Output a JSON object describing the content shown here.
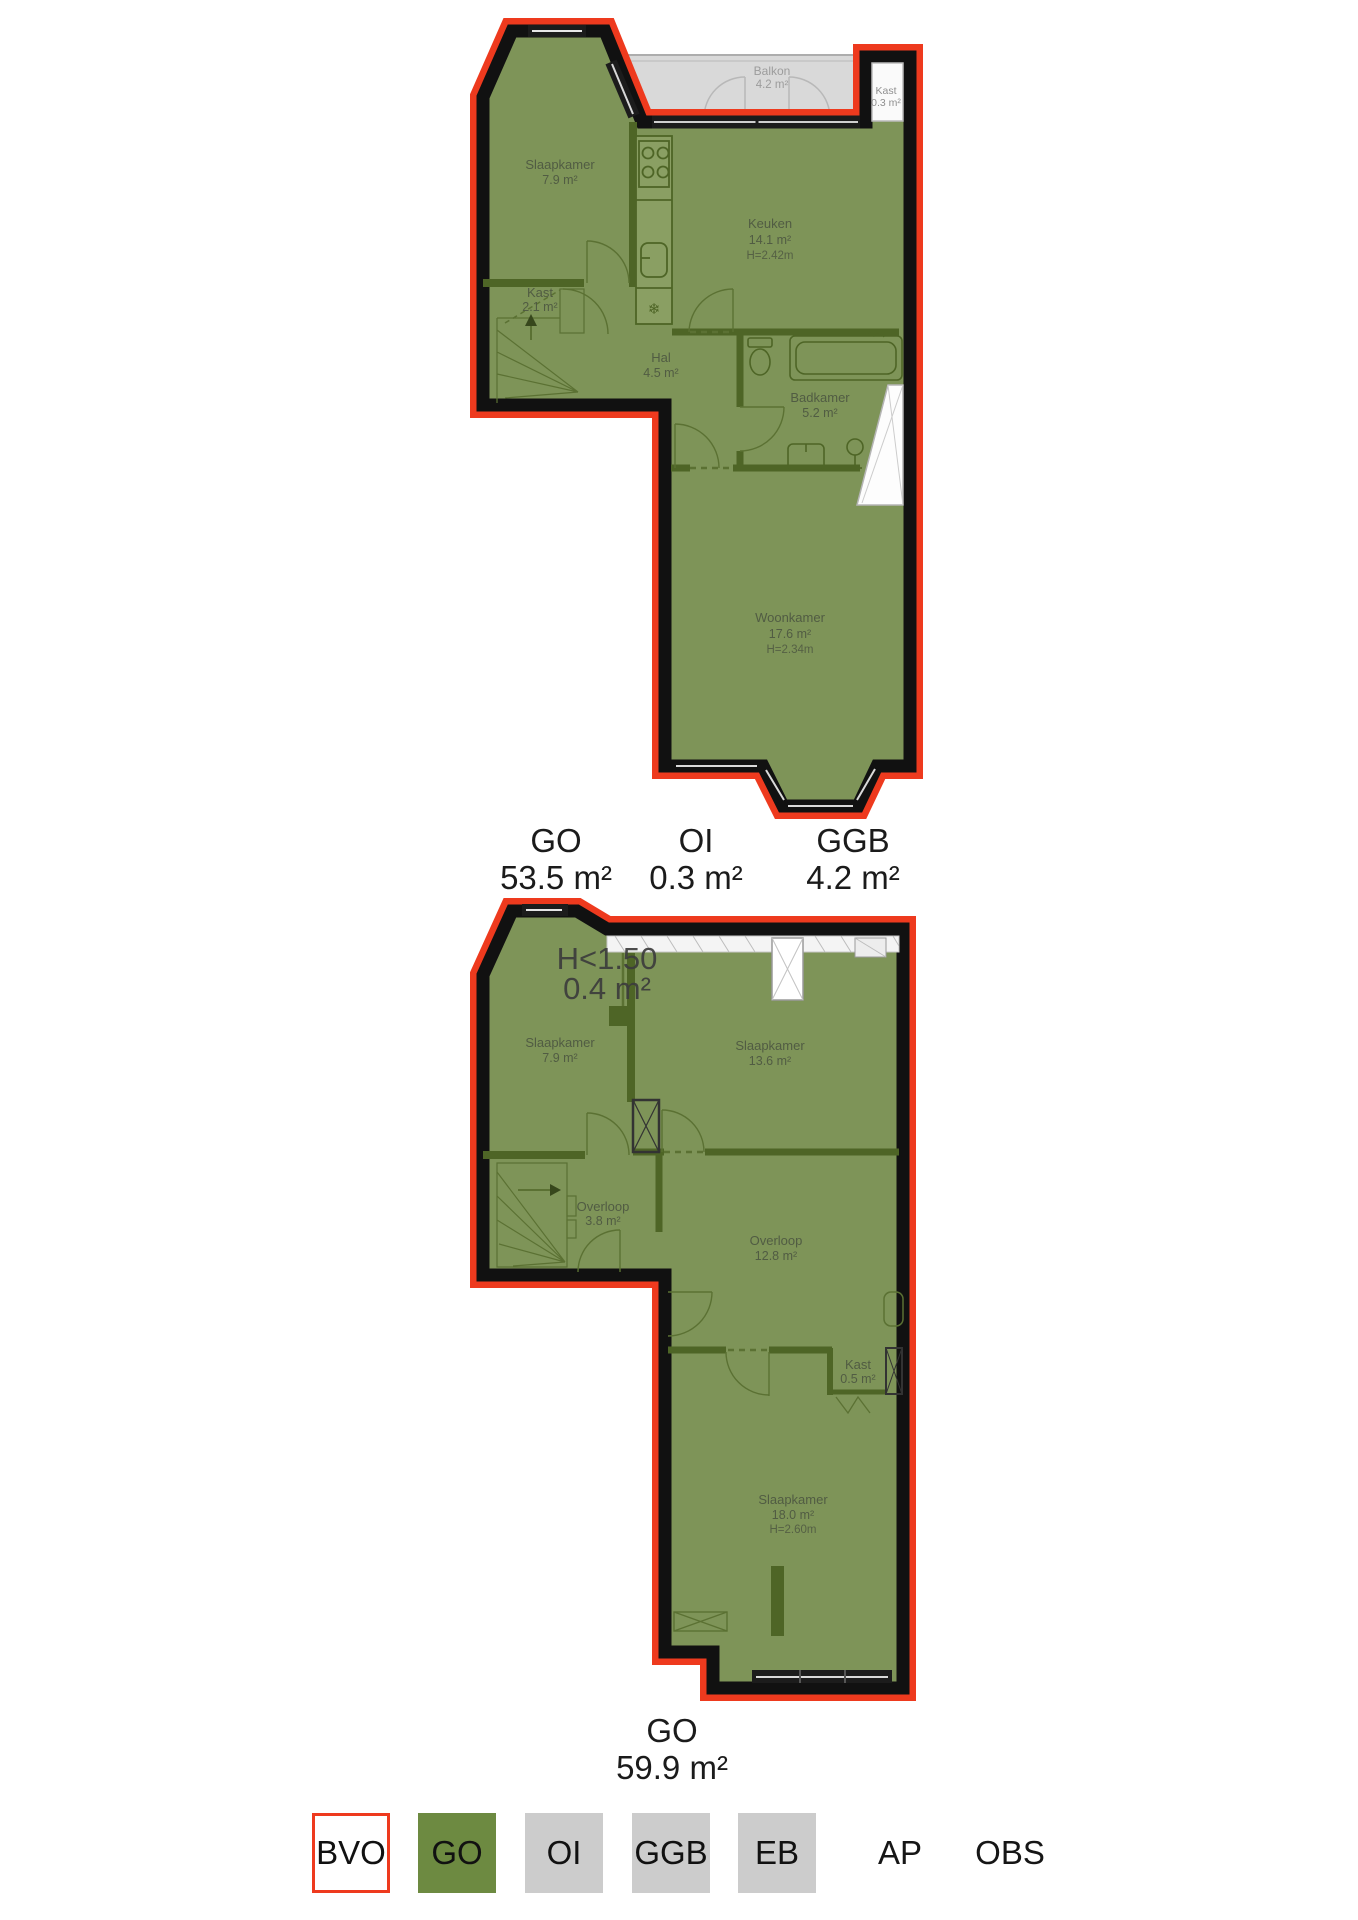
{
  "floor1": {
    "rooms": {
      "slaapkamer": {
        "name": "Slaapkamer",
        "area": "7.9 m²"
      },
      "keuken": {
        "name": "Keuken",
        "area": "14.1 m²",
        "height": "H=2.42m"
      },
      "kast": {
        "name": "Kast",
        "area": "2.1 m²"
      },
      "hal": {
        "name": "Hal",
        "area": "4.5 m²"
      },
      "badkamer": {
        "name": "Badkamer",
        "area": "5.2 m²"
      },
      "woonkamer": {
        "name": "Woonkamer",
        "area": "17.6 m²",
        "height": "H=2.34m"
      },
      "balkon": {
        "name": "Balkon",
        "area": "4.2 m²"
      },
      "kast_oi": {
        "name": "Kast",
        "area": "0.3 m²"
      }
    },
    "totals": {
      "go": {
        "label": "GO",
        "value": "53.5 m²"
      },
      "oi": {
        "label": "OI",
        "value": "0.3 m²"
      },
      "ggb": {
        "label": "GGB",
        "value": "4.2 m²"
      }
    }
  },
  "floor2": {
    "low_height_zone": {
      "label": "H<1.50",
      "value": "0.4 m²"
    },
    "rooms": {
      "slaapkamer_1": {
        "name": "Slaapkamer",
        "area": "7.9 m²"
      },
      "slaapkamer_2": {
        "name": "Slaapkamer",
        "area": "13.6 m²"
      },
      "overloop_klein": {
        "name": "Overloop",
        "area": "3.8 m²"
      },
      "overloop_groot": {
        "name": "Overloop",
        "area": "12.8 m²"
      },
      "kast": {
        "name": "Kast",
        "area": "0.5 m²"
      },
      "slaapkamer_3": {
        "name": "Slaapkamer",
        "area": "18.0 m²",
        "height": "H=2.60m"
      }
    },
    "totals": {
      "go": {
        "label": "GO",
        "value": "59.9 m²"
      }
    }
  },
  "legend": {
    "items": [
      {
        "label": "BVO",
        "fill": "#ffffff",
        "border": "#ee3a1e"
      },
      {
        "label": "GO",
        "fill": "#6d8a41",
        "border": "none"
      },
      {
        "label": "OI",
        "fill": "#cccccc",
        "border": "none"
      },
      {
        "label": "GGB",
        "fill": "#cccccc",
        "border": "none"
      },
      {
        "label": "EB",
        "fill": "#cccccc",
        "border": "none"
      },
      {
        "label": "AP",
        "fill": "none",
        "border": "none"
      },
      {
        "label": "OBS",
        "fill": "none",
        "border": "none"
      }
    ]
  },
  "colors": {
    "bvo_outline": "#ee3a1e",
    "go_fill": "#7e9458",
    "outer_wall": "#111111",
    "interior_wall": "#4e6526",
    "ggb_fill": "#d9d9d9",
    "oi_fill": "#fafafa",
    "legend_grey": "#cccccc",
    "legend_green": "#6d8a41",
    "room_text": "#4d5741",
    "label_text": "#1b1b1b",
    "low_height_text": "#3c3c3c"
  }
}
